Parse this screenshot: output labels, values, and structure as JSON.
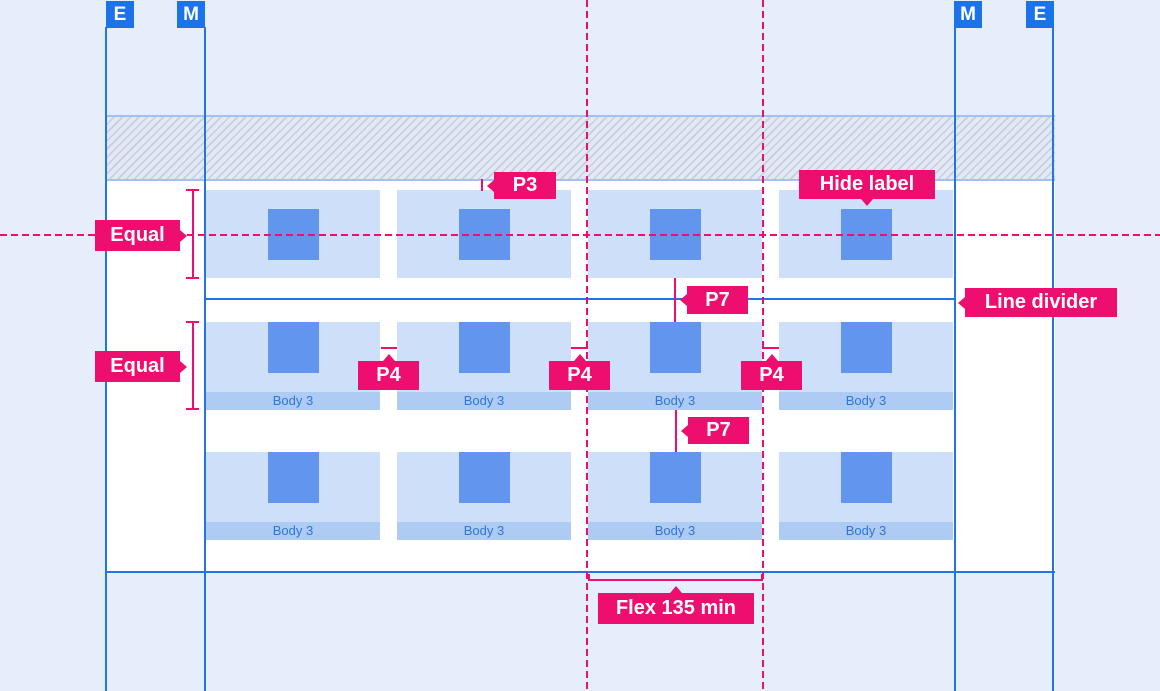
{
  "palette": {
    "background": "#E7EEFB",
    "panel": "#FFFFFF",
    "hatch_bg": "#E2E8F4",
    "hatch_stripe": "#C6CEE0",
    "blue_line": "#2176E3",
    "badge_blue": "#1A73E8",
    "card_fill": "#CDDFF9",
    "tile_fill": "#6296EE",
    "label_band_fill": "#AECBF4",
    "label_band_text": "#2F76DB",
    "annotation_pink": "#EE0E6F"
  },
  "rulers": {
    "badges": [
      {
        "id": "edge-left",
        "label": "E"
      },
      {
        "id": "margin-left",
        "label": "M"
      },
      {
        "id": "margin-right",
        "label": "M"
      },
      {
        "id": "edge-right",
        "label": "E"
      }
    ]
  },
  "grid": {
    "rows": [
      {
        "cells": [
          {
            "label": ""
          },
          {
            "label": ""
          },
          {
            "label": ""
          },
          {
            "label": ""
          }
        ]
      },
      {
        "cells": [
          {
            "label": "Body 3"
          },
          {
            "label": "Body 3"
          },
          {
            "label": "Body 3"
          },
          {
            "label": "Body 3"
          }
        ]
      },
      {
        "cells": [
          {
            "label": "Body 3"
          },
          {
            "label": "Body 3"
          },
          {
            "label": "Body 3"
          },
          {
            "label": "Body 3"
          }
        ]
      }
    ]
  },
  "annotations": {
    "equal_top": "Equal",
    "equal_bottom": "Equal",
    "p3": "P3",
    "hide_label": "Hide label",
    "p7_divider": "P7",
    "line_divider": "Line divider",
    "p4_gap_1": "P4",
    "p4_gap_2": "P4",
    "p4_gap_3": "P4",
    "p7_row_gap": "P7",
    "flex_min": "Flex 135 min"
  }
}
